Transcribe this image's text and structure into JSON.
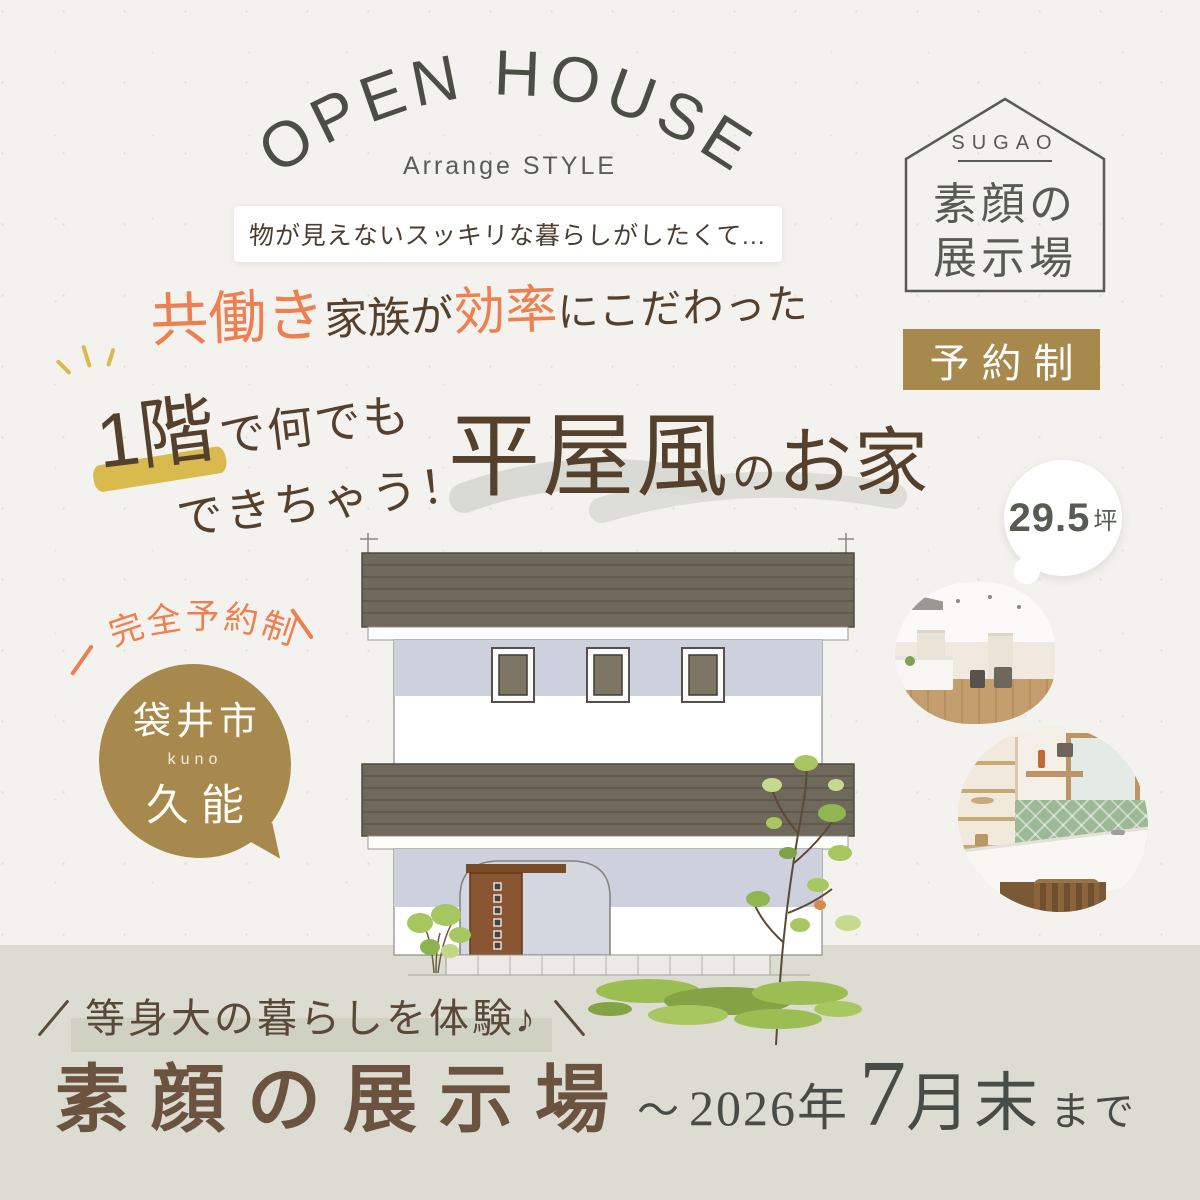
{
  "header": {
    "arc_title": "OPEN HOUSE",
    "subtitle": "Arrange STYLE",
    "note": "物が見えないスッキリな暮らしがしたくて..."
  },
  "catchline": {
    "seg1": "共働き",
    "seg2": "家族が",
    "seg3": "効率",
    "seg4": "にこだわった"
  },
  "headline": {
    "floor": "1階",
    "rest1": "で何でも",
    "rest2": "できちゃう！",
    "main": "平屋風",
    "particle": "の",
    "tail": "お家"
  },
  "sugao_badge": {
    "en": "SUGAO",
    "line1": "素顔の",
    "line2": "展示場"
  },
  "reserve_badge": {
    "label": "予約制"
  },
  "area_bubble": {
    "value": "29.5",
    "unit": "坪"
  },
  "left_note": {
    "label": "完全予約制"
  },
  "location_bubble": {
    "city": "袋井市",
    "romaji": "kuno",
    "name": "久能"
  },
  "footer": {
    "tagline": "等身大の暮らしを体験♪",
    "title": "素顔の展示場",
    "tilde": "～",
    "year": "2026年",
    "month_num": "7",
    "month_unit": "月末",
    "until": "まで"
  },
  "colors": {
    "paper": "#f3f2ee",
    "accent_orange": "#ec8050",
    "brand_gold": "#a7894d",
    "text_brown": "#54402c",
    "dark_olive": "#4a4e44",
    "highlight_yellow": "#d9ba4e",
    "roof_gray": "#6f695c",
    "wall_band_blue": "#ccd1dd",
    "footer_band": "#dcdcd2",
    "footer_title_brown": "#6b5340",
    "tile_green": "#9db894"
  }
}
